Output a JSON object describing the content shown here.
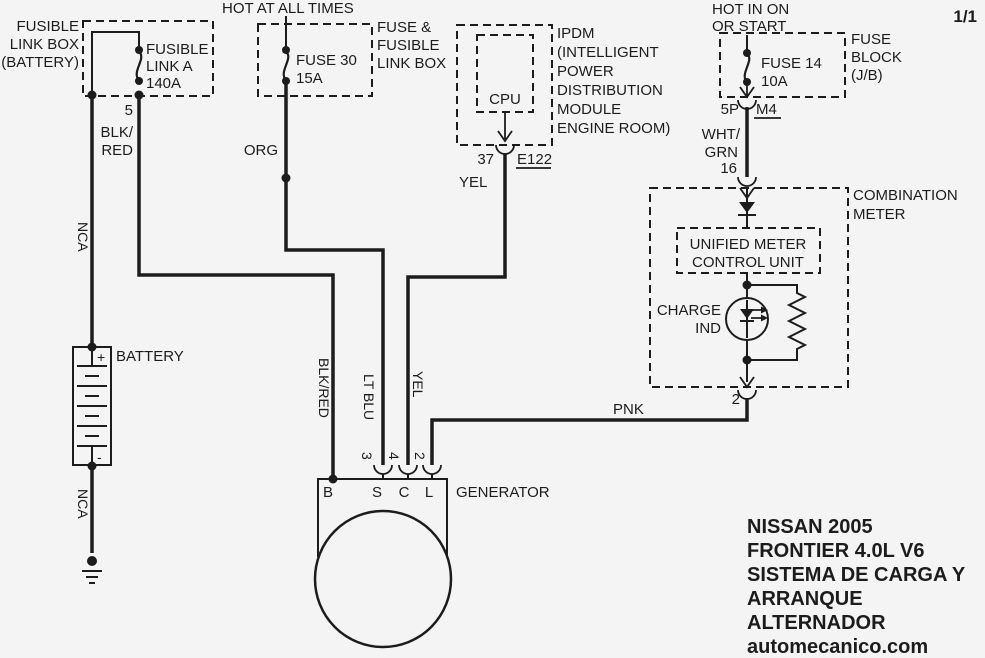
{
  "sheet_indicator": "1/1",
  "fusible_link_box": {
    "label": [
      "FUSIBLE",
      "LINK BOX",
      "(BATTERY)"
    ],
    "component": [
      "FUSIBLE",
      "LINK A",
      "140A"
    ],
    "pin": "5",
    "wire_color": [
      "BLK/",
      "RED"
    ]
  },
  "fuse_fusible_link_box": {
    "power_source": "HOT AT ALL TIMES",
    "label": [
      "FUSE &",
      "FUSIBLE",
      "LINK BOX"
    ],
    "component": [
      "FUSE 30",
      "15A"
    ],
    "wire_color": "ORG"
  },
  "ipdm": {
    "label": [
      "IPDM",
      "(INTELLIGENT",
      "POWER",
      "DISTRIBUTION",
      "MODULE",
      "ENGINE ROOM)"
    ],
    "component": "CPU",
    "pin": "37",
    "connector": "E122",
    "wire_color": "YEL"
  },
  "fuse_block": {
    "power_source": [
      "HOT IN ON",
      "OR START"
    ],
    "label": [
      "FUSE",
      "BLOCK",
      "(J/B)"
    ],
    "component": [
      "FUSE 14",
      "10A"
    ],
    "pin": "5P",
    "connector": "M4",
    "wire_color": [
      "WHT/",
      "GRN"
    ],
    "meter_pin": "16"
  },
  "combination_meter": {
    "label": [
      "COMBINATION",
      "METER"
    ],
    "unified_meter_control_unit": [
      "UNIFIED METER",
      "CONTROL UNIT"
    ],
    "charge_indicator": [
      "CHARGE",
      "IND"
    ],
    "output_pin": "2",
    "wire_color": "PNK"
  },
  "battery": {
    "label": "BATTERY",
    "positive": "+",
    "negative": "-",
    "wire_color_top": "NCA",
    "wire_color_bottom": "NCA"
  },
  "generator": {
    "label": "GENERATOR",
    "terminals": [
      "B",
      "S",
      "C",
      "L"
    ],
    "pins": [
      "3",
      "4",
      "2"
    ],
    "wire_colors": [
      "BLK/RED",
      "LT BLU",
      "YEL"
    ]
  },
  "footer": [
    "NISSAN 2005",
    "FRONTIER 4.0L V6",
    "SISTEMA DE CARGA Y",
    "ARRANQUE",
    "ALTERNADOR",
    "automecanico.com"
  ]
}
